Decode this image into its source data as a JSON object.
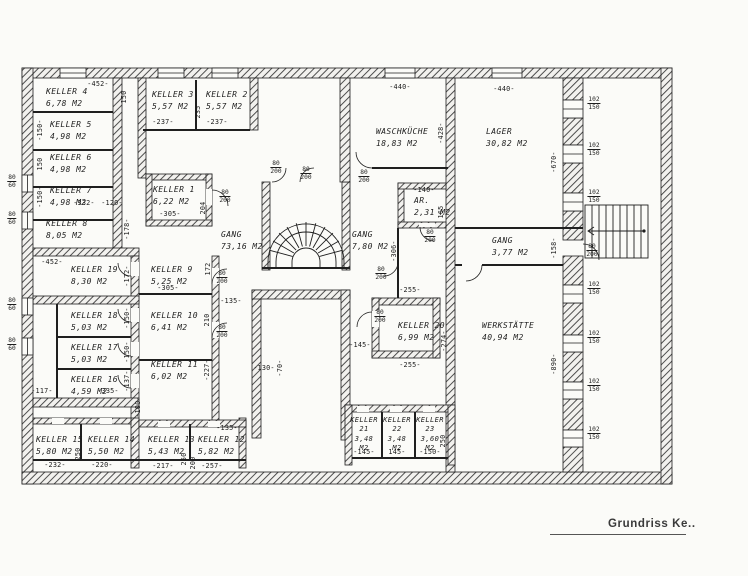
{
  "title": {
    "text": "Grundriss Ke.."
  },
  "rooms": [
    {
      "name": "KELLER 4",
      "area": "6,78 M2"
    },
    {
      "name": "KELLER 3",
      "area": "5,57 M2"
    },
    {
      "name": "KELLER 2",
      "area": "5,57 M2"
    },
    {
      "name": "KELLER 5",
      "area": "4,98 M2"
    },
    {
      "name": "KELLER 6",
      "area": "4,98 M2"
    },
    {
      "name": "KELLER 7",
      "area": "4,98 M2"
    },
    {
      "name": "KELLER 8",
      "area": "8,05 M2"
    },
    {
      "name": "KELLER 1",
      "area": "6,22 M2"
    },
    {
      "name": "GANG",
      "area": "73,16 M2"
    },
    {
      "name": "WASCHKÜCHE",
      "area": "18,83 M2"
    },
    {
      "name": "LAGER",
      "area": "30,82 M2"
    },
    {
      "name": "AR.",
      "area": "2,31 M2"
    },
    {
      "name": "GANG",
      "area": "7,80 M2"
    },
    {
      "name": "GANG",
      "area": "3,77 M2"
    },
    {
      "name": "KELLER 19",
      "area": "8,30 M2"
    },
    {
      "name": "KELLER 9",
      "area": "5,25 M2"
    },
    {
      "name": "KELLER 18",
      "area": "5,03 M2"
    },
    {
      "name": "KELLER 10",
      "area": "6,41 M2"
    },
    {
      "name": "KELLER 17",
      "area": "5,03 M2"
    },
    {
      "name": "KELLER 16",
      "area": "4,59 M2"
    },
    {
      "name": "KELLER 11",
      "area": "6,02 M2"
    },
    {
      "name": "KELLER 20",
      "area": "6,99 M2"
    },
    {
      "name": "WERKSTÄTTE",
      "area": "40,94 M2"
    },
    {
      "name": "KELLER 15",
      "area": "5,80 M2"
    },
    {
      "name": "KELLER 14",
      "area": "5,50 M2"
    },
    {
      "name": "KELLER 13",
      "area": "5,43 M2"
    },
    {
      "name": "KELLER 12",
      "area": "5,82 M2"
    },
    {
      "name": "KELLER 21",
      "area": "3,48 M2"
    },
    {
      "name": "KELLER 22",
      "area": "3,48 M2"
    },
    {
      "name": "KELLER 23",
      "area": "3,60 M2"
    }
  ],
  "dims": {
    "a452_top": "-452-",
    "k4_150": "150",
    "k3_237": "-237-",
    "k3_235": "235",
    "k2_237": "-237-",
    "k5_150": "-150-",
    "k6_150": "150",
    "k7_150": "-150-",
    "k7_332": "-332-",
    "k7_120": "-120-",
    "k1_305": "-305-",
    "k1_204": "204",
    "k8_178": "-178-",
    "g_100": "-100-",
    "k19_452": "-452-",
    "k19_172": "-172-",
    "k9_172": "172",
    "k9_305": "-305-",
    "c_135": "-135-",
    "k18_150": "-150-",
    "k10_210": "210",
    "k17_150": "-150-",
    "k16_137": "-137-",
    "k16_335": "-335-",
    "l_117": "-117-",
    "k11_227": "-227-",
    "k15_232": "-232-",
    "k14_220": "-220-",
    "k15_250": "250",
    "k13_217": "-217-",
    "k13_250": "250",
    "k12_200": "200",
    "k12_257": "-257-",
    "k12_135": "-135-",
    "w_440": "-440-",
    "w_428": "-428-",
    "lg_440": "-440-",
    "lg_670": "-670-",
    "ar_140": "-140-",
    "ar_165": "165",
    "g2_306": "-306-",
    "g3_158": "-158-",
    "k20_255t": "-255-",
    "k20_255b": "-255-",
    "k20_274": "-274-",
    "k20_145": "-145-",
    "s_130": "-130-",
    "s_70": "-70-",
    "wk_890": "-890-",
    "k21_145": "-145-",
    "k22_145": "145-",
    "k23_150": "-150-",
    "k23_250": "250"
  },
  "doors": [
    {
      "w": "80",
      "h": "200"
    },
    {
      "w": "80",
      "h": "200"
    },
    {
      "w": "80",
      "h": "200"
    },
    {
      "w": "80",
      "h": "200"
    },
    {
      "w": "80",
      "h": "200"
    },
    {
      "w": "80",
      "h": "200"
    },
    {
      "w": "80",
      "h": "200"
    },
    {
      "w": "80",
      "h": "200"
    },
    {
      "w": "80",
      "h": "200"
    },
    {
      "w": "80",
      "h": "200"
    }
  ],
  "windows_left": [
    {
      "w": "80",
      "h": "60"
    },
    {
      "w": "80",
      "h": "60"
    },
    {
      "w": "80",
      "h": "60"
    },
    {
      "w": "80",
      "h": "60"
    }
  ],
  "windows_right": [
    {
      "w": "102",
      "h": "150"
    },
    {
      "w": "102",
      "h": "150"
    },
    {
      "w": "102",
      "h": "150"
    },
    {
      "w": "102",
      "h": "150"
    },
    {
      "w": "102",
      "h": "150"
    },
    {
      "w": "102",
      "h": "150"
    },
    {
      "w": "102",
      "h": "150"
    }
  ]
}
